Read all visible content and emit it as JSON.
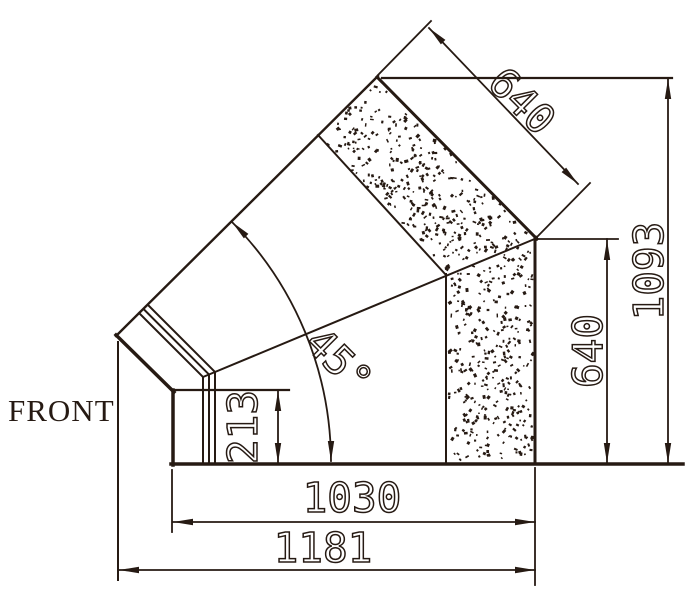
{
  "drawing": {
    "front_label": "FRONT",
    "dimensions": {
      "top_port_width": "640",
      "overall_height": "1093",
      "right_port_height": "640",
      "bend_angle": "45°",
      "front_chamfer_height": "213",
      "body_bottom_length": "1030",
      "overall_length": "1181"
    },
    "colors": {
      "ink": "#261a13",
      "paper": "#ffffff"
    }
  }
}
